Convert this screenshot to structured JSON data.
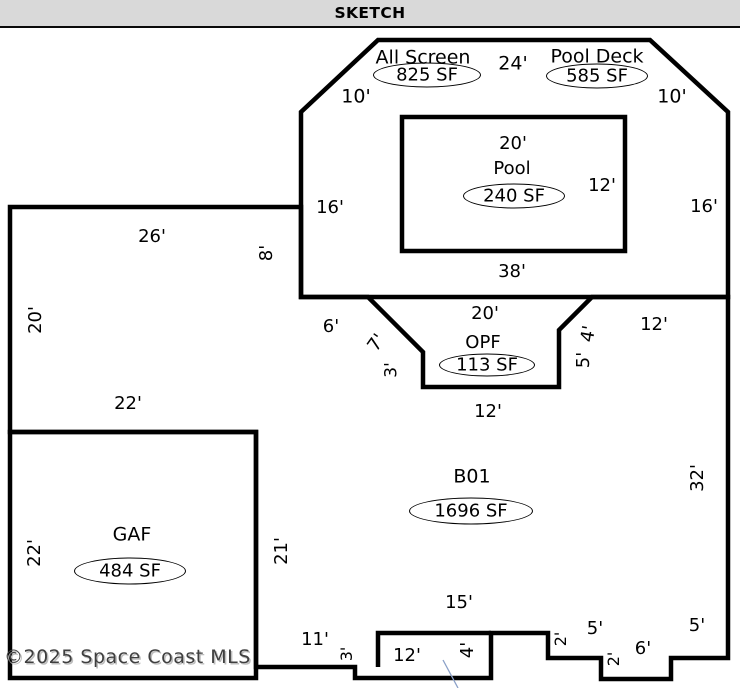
{
  "header": {
    "title": "SKETCH"
  },
  "footer": {
    "copyright": "©2025 Space Coast MLS"
  },
  "colors": {
    "wall": "#000000",
    "background": "#ffffff",
    "header_bg": "#d9d9d9",
    "header_border": "#0a0a0a",
    "note_line": "#8aa0c8",
    "copyright_text": "#3f3f3f"
  },
  "sketch": {
    "areas": [
      {
        "name": "All Screen",
        "sf": "825 SF"
      },
      {
        "name": "Pool Deck",
        "sf": "585 SF"
      },
      {
        "name": "Pool",
        "sf": "240 SF"
      },
      {
        "name": "OPF",
        "sf": "113 SF"
      },
      {
        "name": "B01",
        "sf": "1696 SF"
      },
      {
        "name": "GAF",
        "sf": "484 SF"
      }
    ],
    "labels": [
      {
        "text": "All Screen",
        "x": 423,
        "y": 58,
        "size": 19,
        "name": "area-label-all-screen"
      },
      {
        "text": "825 SF",
        "x": 427,
        "y": 75,
        "oval": true,
        "w": 108,
        "h": 25,
        "name": "area-sf-all-screen"
      },
      {
        "text": "24'",
        "x": 513,
        "y": 64,
        "size": 19
      },
      {
        "text": "Pool Deck",
        "x": 597,
        "y": 57,
        "size": 19,
        "name": "area-label-pool-deck"
      },
      {
        "text": "585 SF",
        "x": 597,
        "y": 76,
        "oval": true,
        "w": 102,
        "h": 25,
        "name": "area-sf-pool-deck"
      },
      {
        "text": "10'",
        "x": 356,
        "y": 97,
        "size": 19
      },
      {
        "text": "10'",
        "x": 672,
        "y": 97,
        "size": 19
      },
      {
        "text": "20'",
        "x": 513,
        "y": 144
      },
      {
        "text": "Pool",
        "x": 512,
        "y": 169,
        "name": "area-label-pool"
      },
      {
        "text": "240 SF",
        "x": 514,
        "y": 196,
        "oval": true,
        "w": 102,
        "h": 25,
        "name": "area-sf-pool"
      },
      {
        "text": "12'",
        "x": 602,
        "y": 186
      },
      {
        "text": "16'",
        "x": 330,
        "y": 208
      },
      {
        "text": "16'",
        "x": 704,
        "y": 207
      },
      {
        "text": "38'",
        "x": 512,
        "y": 272
      },
      {
        "text": "26'",
        "x": 152,
        "y": 237
      },
      {
        "text": "8'",
        "x": 267,
        "y": 253,
        "rot": -90
      },
      {
        "text": "20'",
        "x": 36,
        "y": 320,
        "rot": -90
      },
      {
        "text": "22'",
        "x": 128,
        "y": 404
      },
      {
        "text": "6'",
        "x": 331,
        "y": 327
      },
      {
        "text": "7'",
        "x": 377,
        "y": 343,
        "rot": -55
      },
      {
        "text": "3'",
        "x": 392,
        "y": 370,
        "rot": -90,
        "size": 17
      },
      {
        "text": "20'",
        "x": 485,
        "y": 314
      },
      {
        "text": "OPF",
        "x": 483,
        "y": 343,
        "name": "area-label-opf"
      },
      {
        "text": "113 SF",
        "x": 487,
        "y": 365,
        "oval": true,
        "w": 96,
        "h": 23,
        "name": "area-sf-opf"
      },
      {
        "text": "4'",
        "x": 589,
        "y": 334,
        "rot": -80
      },
      {
        "text": "5'",
        "x": 584,
        "y": 360,
        "rot": -90
      },
      {
        "text": "12'",
        "x": 654,
        "y": 325
      },
      {
        "text": "12'",
        "x": 488,
        "y": 412
      },
      {
        "text": "B01",
        "x": 472,
        "y": 477,
        "size": 19,
        "name": "area-label-b01"
      },
      {
        "text": "1696 SF",
        "x": 471,
        "y": 511,
        "oval": true,
        "w": 124,
        "h": 27,
        "name": "area-sf-b01"
      },
      {
        "text": "32'",
        "x": 698,
        "y": 478,
        "rot": -90
      },
      {
        "text": "GAF",
        "x": 132,
        "y": 535,
        "size": 19,
        "name": "area-label-gaf"
      },
      {
        "text": "484 SF",
        "x": 130,
        "y": 571,
        "oval": true,
        "w": 112,
        "h": 27,
        "name": "area-sf-gaf"
      },
      {
        "text": "22'",
        "x": 35,
        "y": 553,
        "rot": -90
      },
      {
        "text": "21'",
        "x": 282,
        "y": 551,
        "rot": -90
      },
      {
        "text": "15'",
        "x": 459,
        "y": 603
      },
      {
        "text": "11'",
        "x": 315,
        "y": 640
      },
      {
        "text": "3'",
        "x": 347,
        "y": 654,
        "rot": -90,
        "size": 16
      },
      {
        "text": "12'",
        "x": 407,
        "y": 656
      },
      {
        "text": "4'",
        "x": 468,
        "y": 650,
        "rot": -90
      },
      {
        "text": "2'",
        "x": 561,
        "y": 639,
        "rot": -90,
        "size": 16
      },
      {
        "text": "5'",
        "x": 595,
        "y": 629
      },
      {
        "text": "2'",
        "x": 614,
        "y": 659,
        "rot": -90,
        "size": 16
      },
      {
        "text": "6'",
        "x": 643,
        "y": 649
      },
      {
        "text": "5'",
        "x": 697,
        "y": 626
      }
    ]
  }
}
